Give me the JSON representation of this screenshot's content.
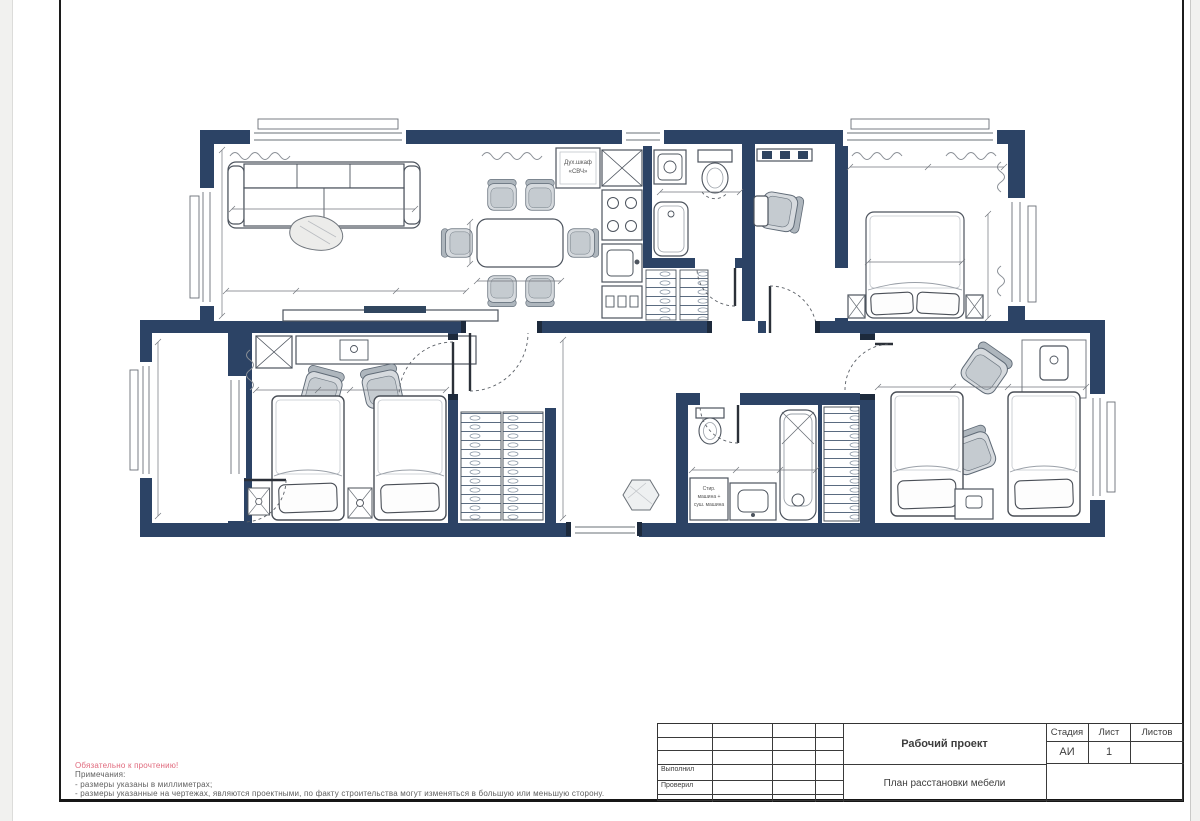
{
  "notes": {
    "warning": "Обязательно к прочтению!",
    "heading": "Примечания:",
    "item1": "- размеры указаны в миллиметрах;",
    "item2": "- размеры указанные на чертежах, являются проектными, по факту строительства могут изменяться в большую или меньшую сторону.",
    "warning_color": "#e06a7d"
  },
  "title_block": {
    "project_type": "Рабочий проект",
    "sheet_title": "План расстановки мебели",
    "stage_label": "Стадия",
    "sheet_label": "Лист",
    "sheets_label": "Листов",
    "stage_value": "АИ",
    "sheet_value": "1",
    "sheets_value": "",
    "performed_label": "Выполнил",
    "checked_label": "Проверил"
  },
  "plan": {
    "wall_color": "#2c4365",
    "labels": {
      "oven_cabinet_line1": "Дух.шкаф",
      "oven_cabinet_line2": "«СВЧ»",
      "laundry_line1": "Стир.",
      "laundry_line2": "машина +",
      "laundry_line3": "суш. машина"
    }
  }
}
